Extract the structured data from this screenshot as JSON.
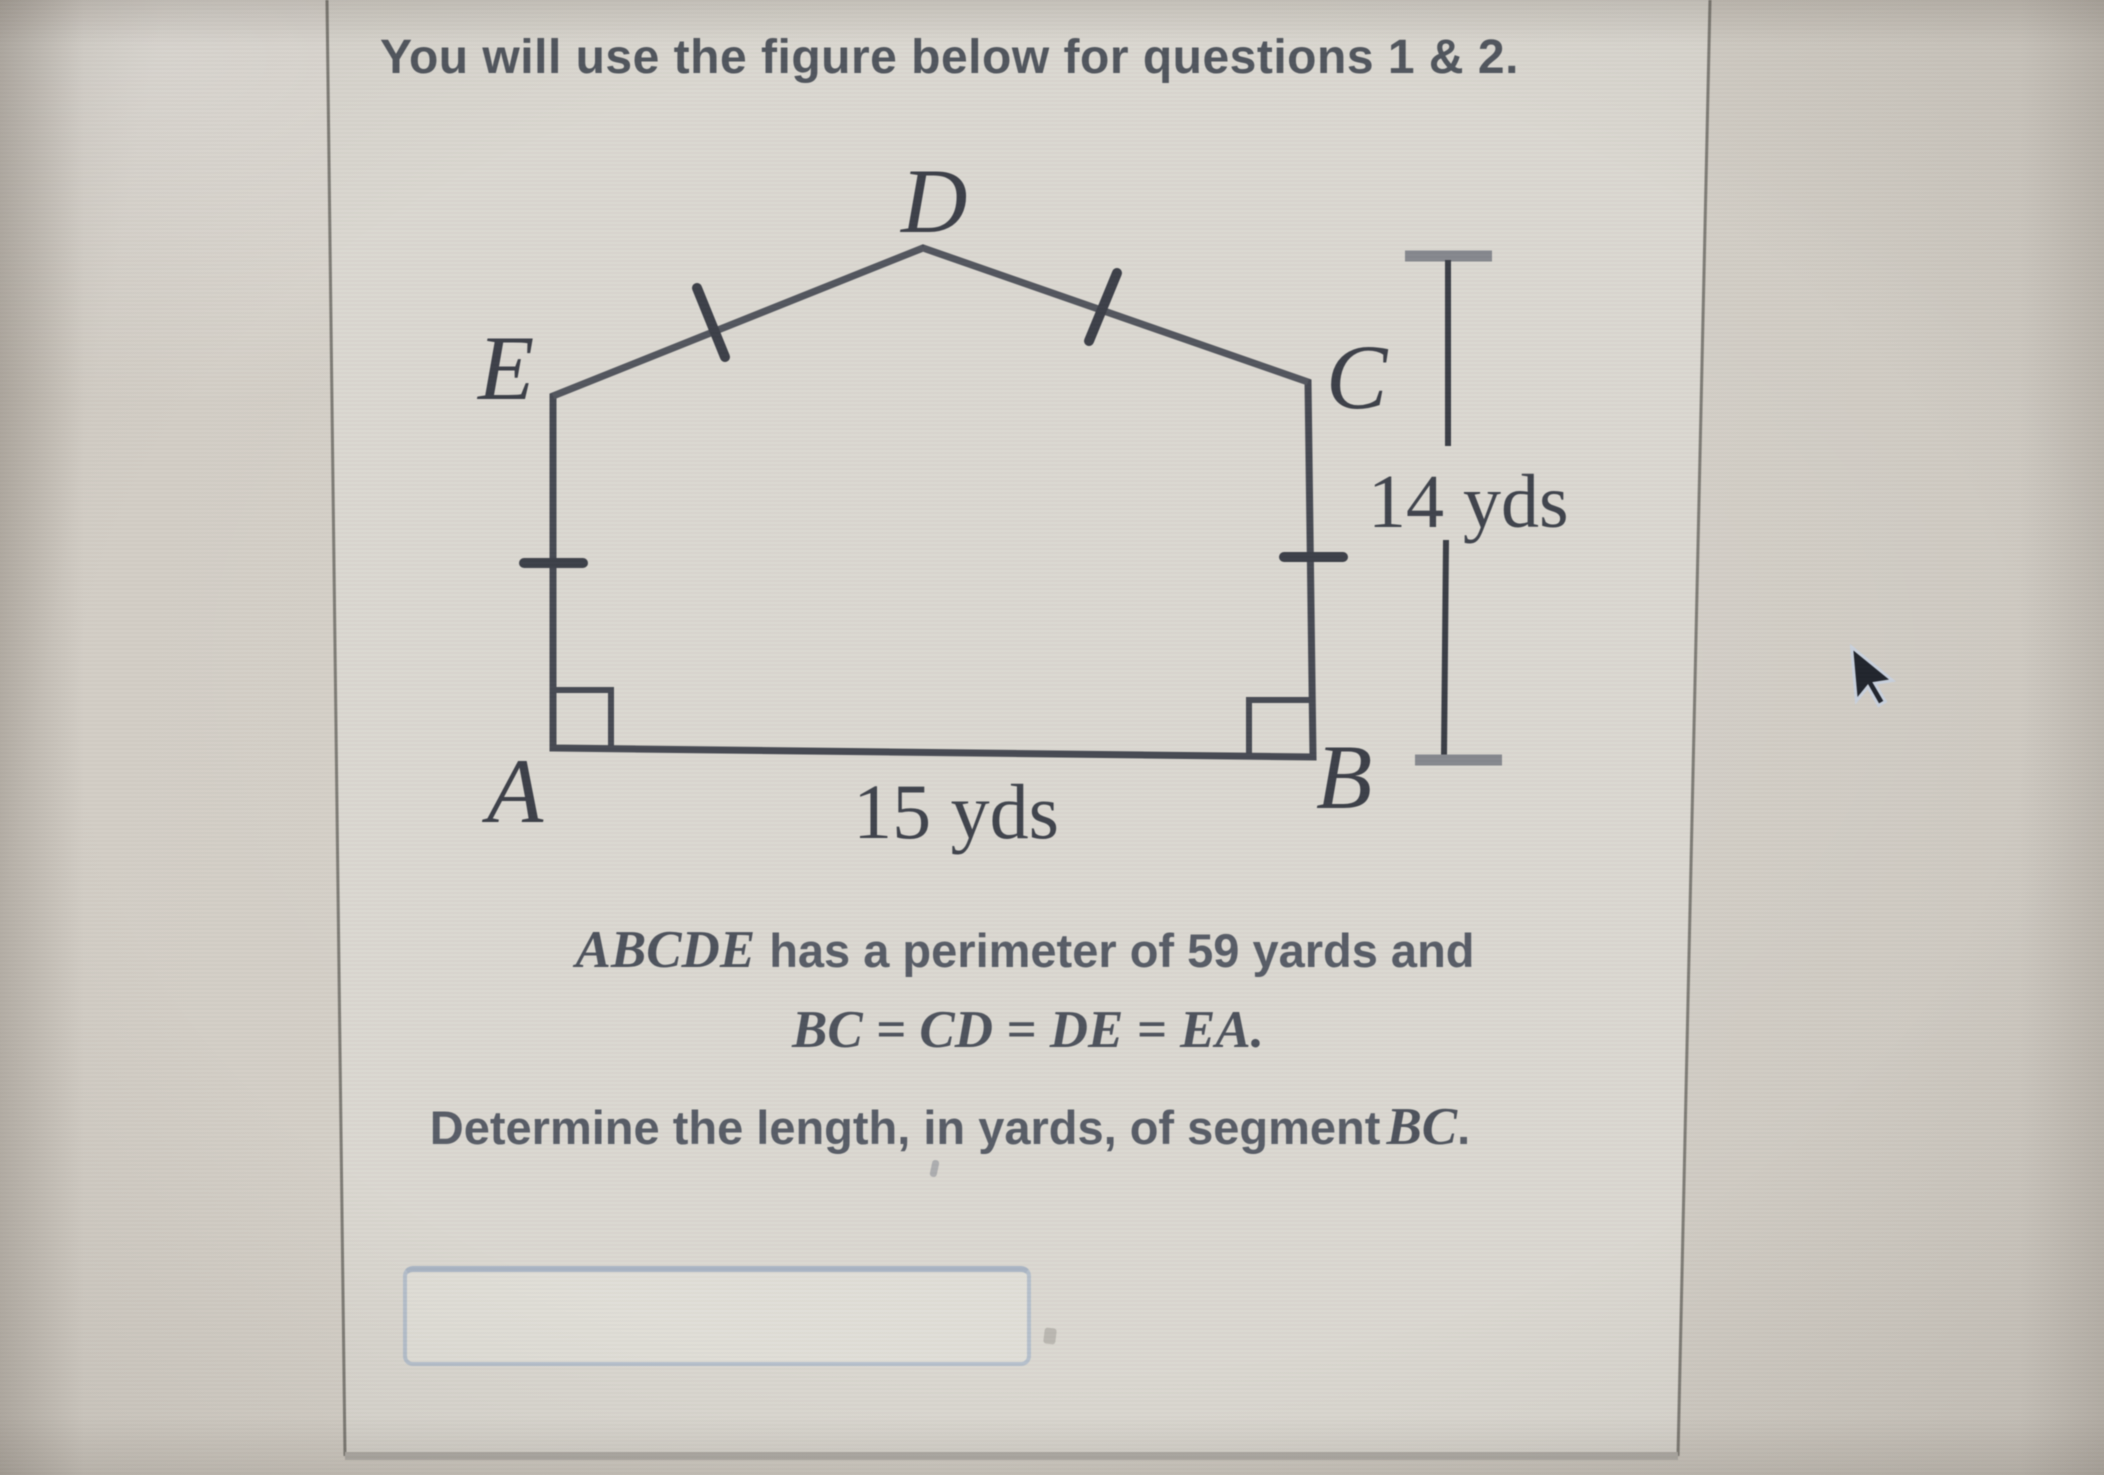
{
  "header": {
    "text": "You will use the figure below for questions 1 & 2."
  },
  "figure": {
    "labels": {
      "a": "A",
      "b": "B",
      "c": "C",
      "d": "D",
      "e": "E"
    },
    "base_length_label": "15 yds",
    "height_label": "14 yds"
  },
  "problem": {
    "line1_math": "ABCDE",
    "line1_text": "has a perimeter of 59 yards and",
    "line2_math": "BC = CD = DE = EA.",
    "line3_text": "Determine the length, in yards, of segment",
    "line3_math": "BC",
    "line3_punct": "."
  },
  "answer": {
    "value": "",
    "placeholder": ""
  },
  "colors": {
    "figure_ink": "#464952",
    "label_ink": "#3c3f48",
    "body_text": "#575c66",
    "header_text": "#50555d",
    "panel_fill": "#dad7d0",
    "panel_border": "#7d7b75",
    "input_border": "#b5bfcb",
    "background": "#cec9c1"
  }
}
